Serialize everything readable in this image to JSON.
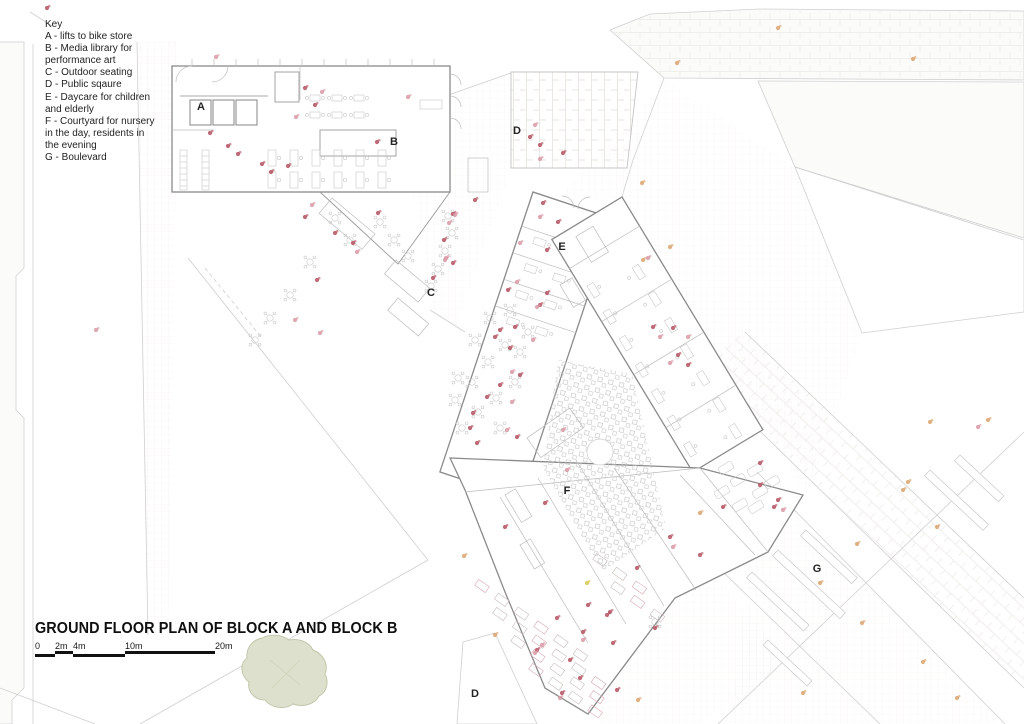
{
  "page_title": "GROUND FLOOR PLAN OF BLOCK A AND BLOCK B",
  "key": {
    "heading": "Key",
    "items": [
      "A - lifts to bike store",
      "B - Media library for performance art",
      "C - Outdoor seating",
      "D - Public sqaure",
      "E - Daycare for children and elderly",
      "F - Courtyard for nursery in the day, residents in the evening",
      "G - Boulevard"
    ]
  },
  "scale_bar": {
    "ticks": [
      {
        "label": "0",
        "x": 0
      },
      {
        "label": "2m",
        "x": 20
      },
      {
        "label": "4m",
        "x": 38
      },
      {
        "label": "10m",
        "x": 90
      },
      {
        "label": "20m",
        "x": 180
      }
    ],
    "total_width": 180
  },
  "plan_labels": [
    {
      "text": "A",
      "x": 201,
      "y": 110
    },
    {
      "text": "B",
      "x": 394,
      "y": 145
    },
    {
      "text": "C",
      "x": 431,
      "y": 296
    },
    {
      "text": "D",
      "x": 517,
      "y": 134
    },
    {
      "text": "E",
      "x": 562,
      "y": 250
    },
    {
      "text": "F",
      "x": 567,
      "y": 494
    },
    {
      "text": "G",
      "x": 817,
      "y": 572
    },
    {
      "text": "D",
      "x": 475,
      "y": 697
    }
  ],
  "colors": {
    "person_red": "#b3505f",
    "person_pink": "#d898a4",
    "person_orange": "#d9a36c",
    "person_yellow": "#d6c54e",
    "tree_fill": "#dde0cc",
    "tree_stroke": "#c2c7ab",
    "ink": "#1c1c1c"
  },
  "people_dots": [
    [
      47,
      8,
      "r"
    ],
    [
      216,
      57,
      "p"
    ],
    [
      210,
      133,
      "r"
    ],
    [
      228,
      146,
      "r"
    ],
    [
      238,
      154,
      "r"
    ],
    [
      262,
      164,
      "r"
    ],
    [
      271,
      172,
      "r"
    ],
    [
      288,
      166,
      "r"
    ],
    [
      305,
      88,
      "r"
    ],
    [
      315,
      105,
      "r"
    ],
    [
      296,
      117,
      "p"
    ],
    [
      322,
      92,
      "p"
    ],
    [
      377,
      142,
      "r"
    ],
    [
      408,
      97,
      "p"
    ],
    [
      312,
      205,
      "p"
    ],
    [
      305,
      217,
      "r"
    ],
    [
      335,
      233,
      "r"
    ],
    [
      353,
      243,
      "r"
    ],
    [
      357,
      252,
      "p"
    ],
    [
      317,
      280,
      "r"
    ],
    [
      378,
      213,
      "r"
    ],
    [
      320,
      333,
      "p"
    ],
    [
      295,
      320,
      "p"
    ],
    [
      453,
      214,
      "r"
    ],
    [
      449,
      223,
      "p"
    ],
    [
      444,
      240,
      "r"
    ],
    [
      446,
      258,
      "p"
    ],
    [
      433,
      278,
      "r"
    ],
    [
      535,
      125,
      "p"
    ],
    [
      540,
      145,
      "r"
    ],
    [
      563,
      153,
      "r"
    ],
    [
      540,
      159,
      "p"
    ],
    [
      530,
      137,
      "r"
    ],
    [
      543,
      203,
      "r"
    ],
    [
      540,
      217,
      "p"
    ],
    [
      558,
      222,
      "r"
    ],
    [
      547,
      250,
      "r"
    ],
    [
      520,
      243,
      "p"
    ],
    [
      547,
      293,
      "r"
    ],
    [
      540,
      305,
      "r"
    ],
    [
      517,
      282,
      "p"
    ],
    [
      508,
      290,
      "r"
    ],
    [
      537,
      307,
      "p"
    ],
    [
      515,
      327,
      "r"
    ],
    [
      500,
      330,
      "r"
    ],
    [
      533,
      340,
      "p"
    ],
    [
      510,
      348,
      "r"
    ],
    [
      495,
      337,
      "r"
    ],
    [
      520,
      375,
      "r"
    ],
    [
      512,
      372,
      "p"
    ],
    [
      500,
      385,
      "r"
    ],
    [
      487,
      397,
      "r"
    ],
    [
      512,
      402,
      "p"
    ],
    [
      473,
      413,
      "r"
    ],
    [
      470,
      428,
      "r"
    ],
    [
      507,
      430,
      "p"
    ],
    [
      517,
      437,
      "r"
    ],
    [
      477,
      443,
      "r"
    ],
    [
      455,
      215,
      "p"
    ],
    [
      453,
      263,
      "r"
    ],
    [
      445,
      260,
      "p"
    ],
    [
      475,
      200,
      "r"
    ],
    [
      670,
      247,
      "o"
    ],
    [
      643,
      260,
      "o"
    ],
    [
      653,
      327,
      "r"
    ],
    [
      660,
      337,
      "p"
    ],
    [
      673,
      328,
      "r"
    ],
    [
      688,
      337,
      "p"
    ],
    [
      678,
      355,
      "r"
    ],
    [
      670,
      363,
      "p"
    ],
    [
      688,
      365,
      "r"
    ],
    [
      563,
      430,
      "p"
    ],
    [
      567,
      470,
      "p"
    ],
    [
      545,
      503,
      "r"
    ],
    [
      505,
      527,
      "r"
    ],
    [
      610,
      612,
      "r"
    ],
    [
      637,
      568,
      "r"
    ],
    [
      670,
      537,
      "r"
    ],
    [
      700,
      513,
      "o"
    ],
    [
      723,
      507,
      "r"
    ],
    [
      760,
      485,
      "r"
    ],
    [
      760,
      463,
      "r"
    ],
    [
      778,
      500,
      "r"
    ],
    [
      774,
      507,
      "r"
    ],
    [
      783,
      510,
      "p"
    ],
    [
      700,
      555,
      "r"
    ],
    [
      673,
      547,
      "p"
    ],
    [
      557,
      618,
      "r"
    ],
    [
      583,
      632,
      "r"
    ],
    [
      588,
      605,
      "r"
    ],
    [
      607,
      615,
      "r"
    ],
    [
      613,
      643,
      "r"
    ],
    [
      583,
      640,
      "p"
    ],
    [
      570,
      660,
      "r"
    ],
    [
      580,
      678,
      "r"
    ],
    [
      562,
      693,
      "r"
    ],
    [
      560,
      698,
      "p"
    ],
    [
      537,
      650,
      "r"
    ],
    [
      542,
      645,
      "p"
    ],
    [
      535,
      653,
      "p"
    ],
    [
      495,
      635,
      "o"
    ],
    [
      587,
      583,
      "y"
    ],
    [
      617,
      690,
      "r"
    ],
    [
      638,
      700,
      "o"
    ],
    [
      655,
      628,
      "r"
    ],
    [
      820,
      583,
      "o"
    ],
    [
      803,
      693,
      "o"
    ],
    [
      862,
      623,
      "o"
    ],
    [
      923,
      662,
      "o"
    ],
    [
      957,
      698,
      "o"
    ],
    [
      937,
      527,
      "o"
    ],
    [
      903,
      490,
      "o"
    ],
    [
      930,
      422,
      "o"
    ],
    [
      988,
      420,
      "o"
    ],
    [
      978,
      427,
      "p"
    ],
    [
      908,
      482,
      "o"
    ],
    [
      778,
      28,
      "o"
    ],
    [
      677,
      63,
      "o"
    ],
    [
      913,
      59,
      "o"
    ],
    [
      642,
      183,
      "o"
    ],
    [
      648,
      258,
      "p"
    ],
    [
      857,
      544,
      "o"
    ],
    [
      464,
      556,
      "o"
    ],
    [
      96,
      330,
      "p"
    ]
  ]
}
